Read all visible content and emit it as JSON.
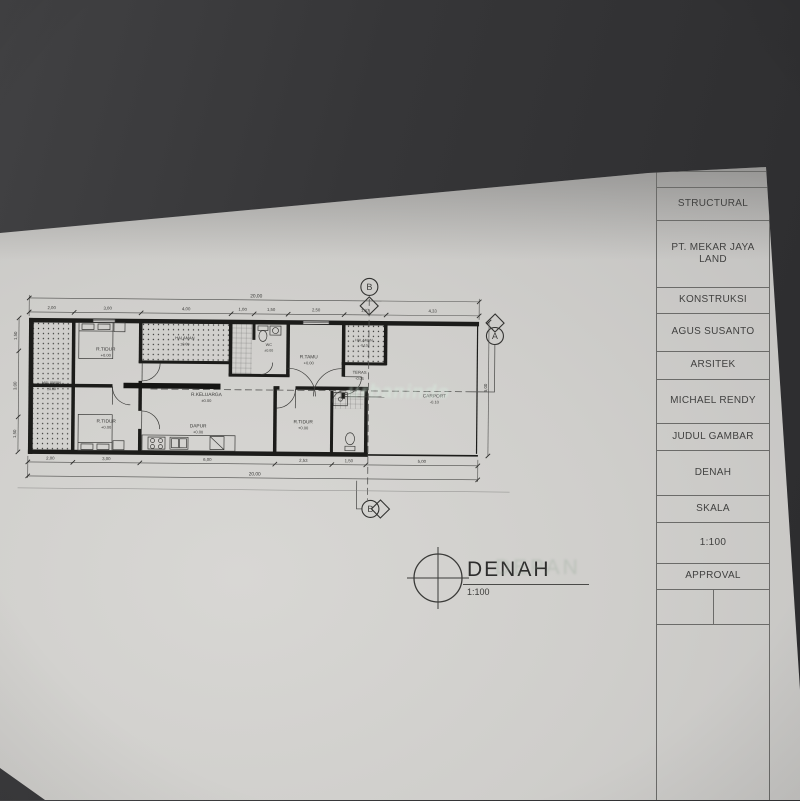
{
  "photo": {
    "background": "#363638",
    "paper": "#cfcecb"
  },
  "title_block": {
    "rows": [
      "",
      "STRUCTURAL",
      "PT. MEKAR JAYA LAND",
      "KONSTRUKSI",
      "AGUS SUSANTO",
      "ARSITEK",
      "MICHAEL RENDY",
      "JUDUL GAMBAR",
      "DENAH",
      "SKALA",
      "1:100",
      "APPROVAL"
    ]
  },
  "drawing": {
    "title": "DENAH",
    "scale": "1:100",
    "rooms": {
      "halaman_left": {
        "name": "HALAMAN",
        "level": "±0.00"
      },
      "tidur_atas": {
        "name": "R.TIDUR",
        "level": "+0.00"
      },
      "halaman_tengah": {
        "name": "HALAMAN",
        "level": "±0.00"
      },
      "wc": {
        "name": "WC",
        "level": "±0.00"
      },
      "tamu": {
        "name": "R.TAMU",
        "level": "+0.00"
      },
      "halaman_depan": {
        "name": "HALAMAN",
        "level": "-0.10"
      },
      "teras": {
        "name": "TERAS",
        "level": "-0.05"
      },
      "carport": {
        "name": "CARPORT",
        "level": "-0.10"
      },
      "keluarga": {
        "name": "R.KELUARGA",
        "level": "±0.00"
      },
      "dapur": {
        "name": "DAPUR",
        "level": "+0.00"
      },
      "tidur_bawah": {
        "name": "R.TIDUR",
        "level": "+0.00"
      },
      "tidur_kanan": {
        "name": "R.TIDUR",
        "level": "+0.00"
      }
    },
    "dimensions": {
      "top_total": "20,00",
      "top_segments": [
        "2,00",
        "3,00",
        "4,00",
        "1,00",
        "1,50",
        "2,50",
        "1,87",
        "4,33"
      ],
      "bottom_total": "20,00",
      "bottom_segments": [
        "2,00",
        "3,00",
        "6,00",
        "2,53",
        "1,50",
        "5,00"
      ],
      "left_segments": [
        "1,50",
        "3,00",
        "1,50"
      ],
      "right_total": "6,00"
    },
    "markers": {
      "a": "A",
      "b": "B"
    }
  },
  "watermarks": {
    "plan": "urbanindo",
    "ghost": "DEPAN"
  }
}
